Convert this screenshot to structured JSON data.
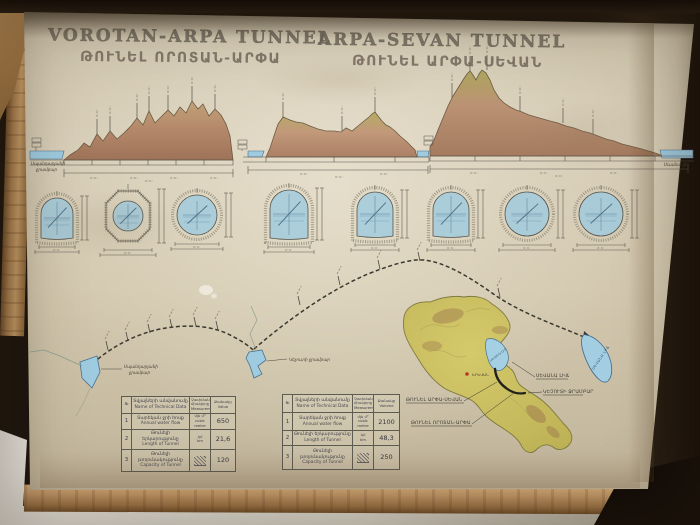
{
  "poster": {
    "title_left_en": "VOROTAN-ARPA TUNNEL",
    "title_left_hy": "ԹՈՒՆԵԼ ՈՐՈՏԱՆ-ԱՐՓԱ",
    "title_right_en": "ARPA-SEVAN TUNNEL",
    "title_right_hy": "ԹՈՒՆԵԼ ԱՐՓԱ-ՍԵՎԱՆ"
  },
  "profiles": {
    "left_water_label_line1": "Սպանդարյանի",
    "left_water_label_line2": "ջրամբար",
    "right_water_label": "Սևանա լիճ"
  },
  "map": {
    "reservoir_left_line1": "Սպանդարյանի",
    "reservoir_left_line2": "ջրամբար",
    "reservoir_mid_label": "Կեչուտի ջրամբար",
    "lake_schematic_label": "ՍԵՎԱՆԱ ԼԻՃ",
    "lake_on_map_label": "ՍԵՎԱՆԱ ԼԻՃ",
    "capital_label": "ԵՐԵՎԱՆ",
    "callout_tunnel_arpa_sevan": "ԹՈՒՆԵԼ ԱՐՓԱ-ՍԵՎԱՆ",
    "callout_tunnel_vorotan_arpa": "ԹՈՒՆԵԼ ՈՐՈՏԱՆ-ԱՐՓԱ",
    "callout_lake_sevan": "ՍԵՎԱՆԱ ԼԻՃ",
    "callout_kechut": "ԿԵՉՈՒՏԻ ՋՐԱՄԲԱՐ"
  },
  "sections": {
    "items": [
      {
        "shape": "horseshoe",
        "cx": 57,
        "cy": 218,
        "w": 32,
        "h": 40
      },
      {
        "shape": "octagon",
        "cx": 128,
        "cy": 216,
        "w": 44,
        "h": 50
      },
      {
        "shape": "circle",
        "cx": 197,
        "cy": 215,
        "r": 20
      },
      {
        "shape": "horseshoe",
        "cx": 289,
        "cy": 214,
        "w": 38,
        "h": 48
      },
      {
        "shape": "horseshoe",
        "cx": 375,
        "cy": 214,
        "w": 36,
        "h": 44
      },
      {
        "shape": "horseshoe",
        "cx": 451,
        "cy": 214,
        "w": 36,
        "h": 44
      },
      {
        "shape": "circle",
        "cx": 527,
        "cy": 214,
        "r": 22
      },
      {
        "shape": "circle",
        "cx": 601,
        "cy": 214,
        "r": 22
      }
    ]
  },
  "tables": {
    "headers": {
      "num": "№",
      "name_hy": "Տվյալների անվանումը",
      "name_en": "Name of Technical Data",
      "unit_hy": "Չափման միավորը",
      "unit_en": "Measurement",
      "qty_hy": "Քանակը"
    },
    "left": {
      "qty_en": "Value",
      "rows": [
        {
          "n": "1",
          "hy": "Տարեկան ջրի հոսք",
          "en": "Annual water flow",
          "unit_top": "մլն մ³",
          "unit_bot": "cubic metre",
          "value": "650"
        },
        {
          "n": "2",
          "hy": "Թունելի երկարությունը",
          "en": "Length of Tunnel",
          "unit_top": "կմ",
          "unit_bot": "km",
          "value": "21,6"
        },
        {
          "n": "3",
          "hy": "Թունելի թողունակությունը",
          "en": "Capacity of Tunnel",
          "unit_top": "",
          "unit_bot": "",
          "value": "120"
        }
      ]
    },
    "right": {
      "qty_en": "Volume",
      "rows": [
        {
          "n": "1",
          "hy": "Տարեկան ջրի հոսք",
          "en": "Annual water flow",
          "unit_top": "մլն մ³",
          "unit_bot": "cubic metre",
          "value": "2100"
        },
        {
          "n": "2",
          "hy": "Թունելի երկարությունը",
          "en": "Length of Tunnel",
          "unit_top": "կմ",
          "unit_bot": "km",
          "value": "48,3"
        },
        {
          "n": "3",
          "hy": "Թունելի թողունակությունը",
          "en": "Capacity of Tunnel",
          "unit_top": "",
          "unit_bot": "",
          "value": "250"
        }
      ]
    }
  },
  "colors": {
    "paper": "#d4cab2",
    "water": "#9ecbe0",
    "mountain_brown": "#b08568",
    "mountain_green": "#b2ab62",
    "ink": "#4a473f",
    "wood": "#b08a5a",
    "map_green": "#c9bd62"
  }
}
